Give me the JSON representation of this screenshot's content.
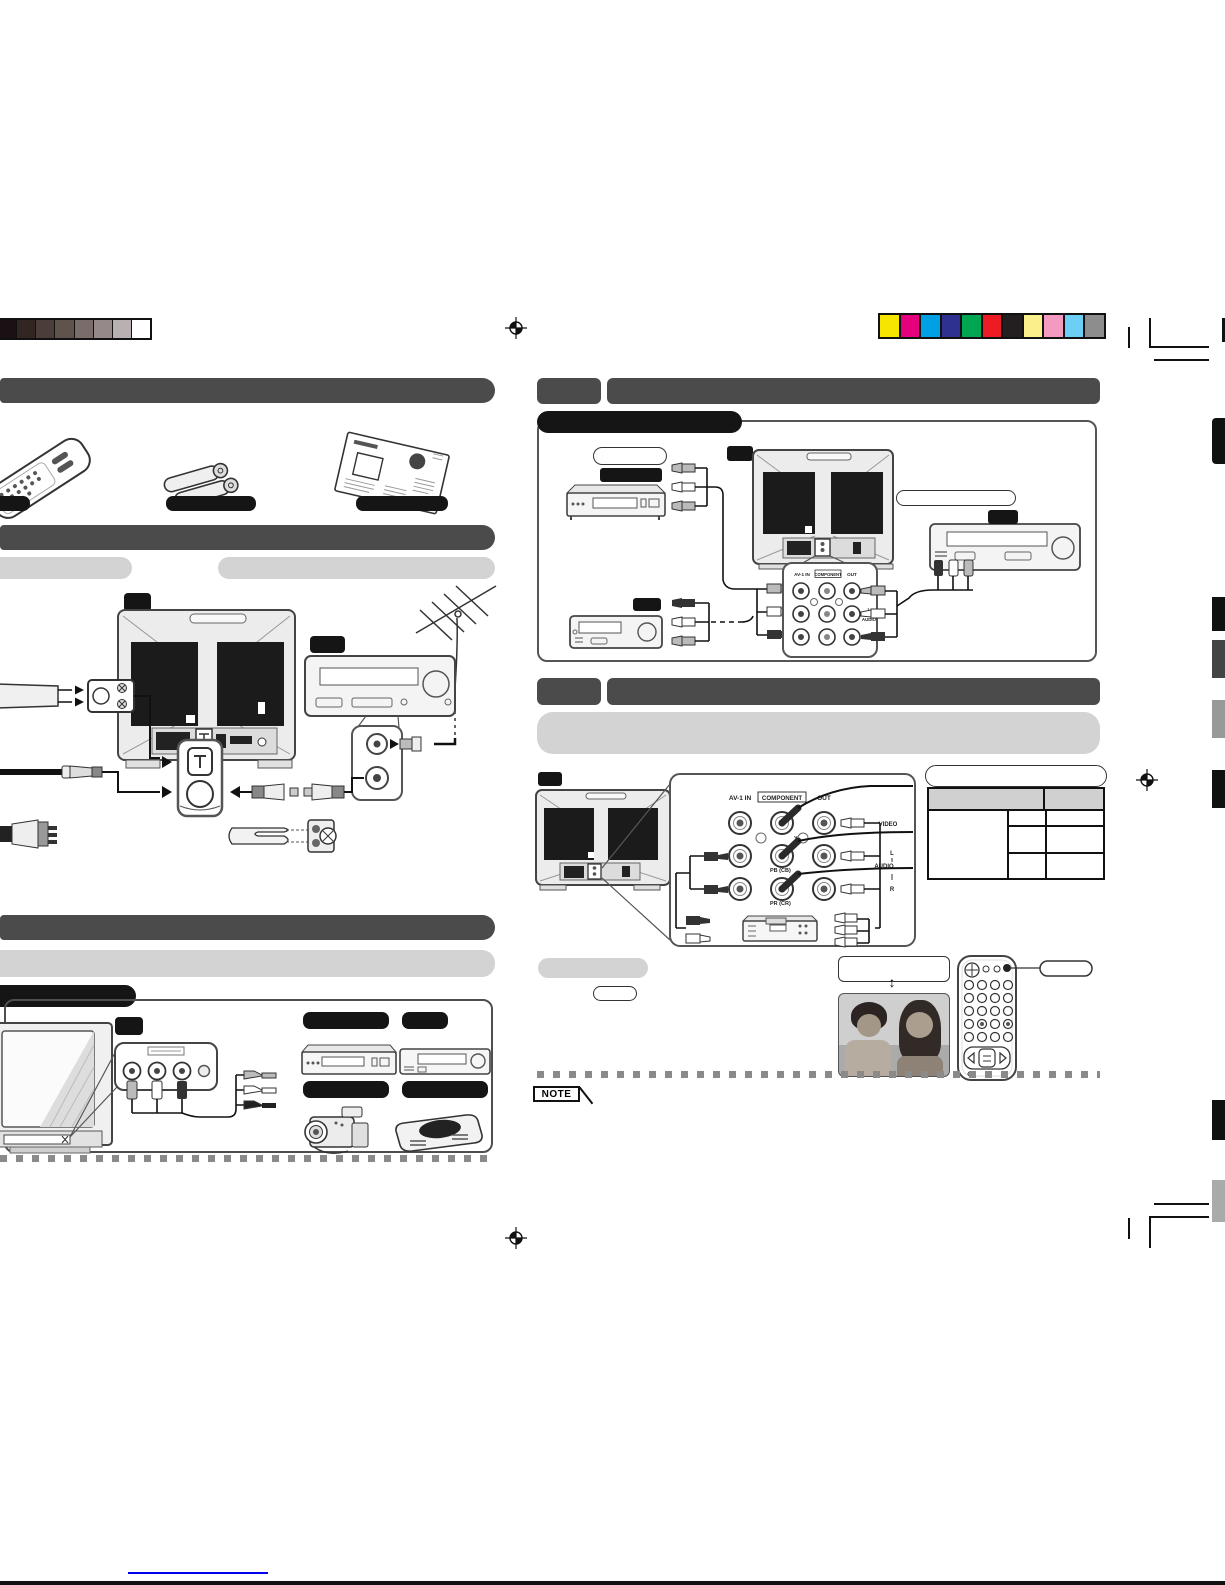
{
  "calibration": {
    "grayscale": [
      "#1a1115",
      "#312622",
      "#4b3d39",
      "#60524d",
      "#7a6d69",
      "#95898a",
      "#b8b0b1",
      "#ffffff"
    ],
    "colors": [
      "#f6e500",
      "#e5007d",
      "#00a0e4",
      "#2f3190",
      "#00a651",
      "#ed1c24",
      "#231f20",
      "#f9f08c",
      "#f49ac1",
      "#6dcff6",
      "#8d8d8d"
    ]
  },
  "jack_panel": {
    "col_headers": [
      "AV-1 IN",
      "COMPONENT",
      "OUT"
    ],
    "component_labels": [
      "Y",
      "PB (CB)",
      "PR (CR)"
    ],
    "row_labels": [
      "VIDEO",
      "L",
      "AUDIO",
      "R"
    ]
  },
  "labels": {
    "note": "NOTE",
    "game": "GAME",
    "updown_arrow": "↕"
  }
}
